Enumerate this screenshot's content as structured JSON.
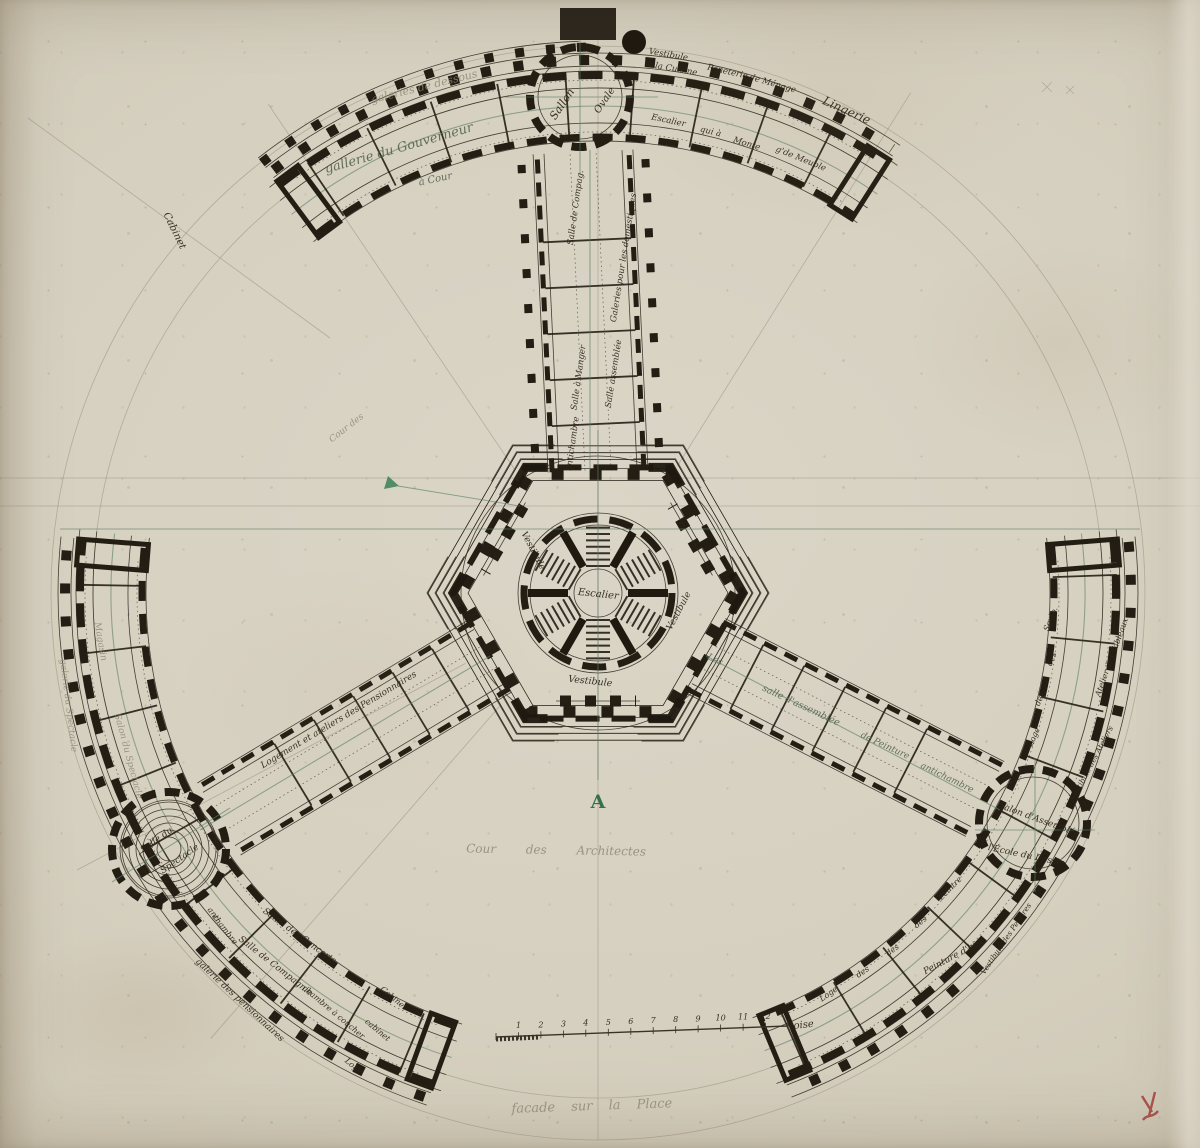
{
  "colors": {
    "paper": "#d6d0c0",
    "ink": "#241e14",
    "green_ink": "#557a5e",
    "pencil": "#8f8673",
    "red_chalk": "#9e3430"
  },
  "annotations": {
    "orientation_letter": "A",
    "court_label": "Cour des Architectes",
    "bottom_caption": "facade sur la Place",
    "scale_unit": "toise",
    "scale_numbers": [
      "1",
      "2",
      "3",
      "4",
      "5",
      "6",
      "7",
      "8",
      "9",
      "10",
      "11",
      "12"
    ]
  },
  "plan_labels": [
    {
      "text": "galeries de dessous",
      "x": 425,
      "y": 90,
      "rot": -14,
      "size": 11,
      "cls": "pencil"
    },
    {
      "text": "gallerie du Gouverneur",
      "x": 400,
      "y": 152,
      "rot": -16,
      "size": 13,
      "cls": "green"
    },
    {
      "text": "à Cour",
      "x": 436,
      "y": 182,
      "rot": -12,
      "size": 10,
      "cls": "green"
    },
    {
      "text": "Cabinet",
      "x": 172,
      "y": 232,
      "rot": 64,
      "size": 10,
      "cls": "ink"
    },
    {
      "text": "Sallon",
      "x": 565,
      "y": 106,
      "rot": -56,
      "size": 11,
      "cls": "ink"
    },
    {
      "text": "Ovale",
      "x": 607,
      "y": 102,
      "rot": -56,
      "size": 10,
      "cls": "ink"
    },
    {
      "text": "Vestibule",
      "x": 668,
      "y": 57,
      "rot": 10,
      "size": 8.5,
      "cls": "ink"
    },
    {
      "text": "à la Cuisine",
      "x": 672,
      "y": 71,
      "rot": 10,
      "size": 8.5,
      "cls": "ink"
    },
    {
      "text": "Paneterie",
      "x": 727,
      "y": 74,
      "rot": 13,
      "size": 8.5,
      "cls": "ink"
    },
    {
      "text": "de Ménage",
      "x": 772,
      "y": 86,
      "rot": 16,
      "size": 8.5,
      "cls": "ink"
    },
    {
      "text": "Lingerie",
      "x": 845,
      "y": 114,
      "rot": 24,
      "size": 12,
      "cls": "ink"
    },
    {
      "text": "Escalier",
      "x": 668,
      "y": 123,
      "rot": 12,
      "size": 8.5,
      "cls": "ink"
    },
    {
      "text": "qui à",
      "x": 710,
      "y": 134,
      "rot": 14,
      "size": 8.5,
      "cls": "ink"
    },
    {
      "text": "Monte",
      "x": 746,
      "y": 146,
      "rot": 17,
      "size": 8.5,
      "cls": "ink"
    },
    {
      "text": "g'de Meuble",
      "x": 800,
      "y": 161,
      "rot": 22,
      "size": 8.5,
      "cls": "ink"
    },
    {
      "text": "Salle de Compag.",
      "x": 578,
      "y": 208,
      "rot": -82,
      "size": 8.5,
      "cls": "ink"
    },
    {
      "text": "Salle à Manger",
      "x": 581,
      "y": 378,
      "rot": -82,
      "size": 8.5,
      "cls": "ink"
    },
    {
      "text": "antichambre",
      "x": 575,
      "y": 444,
      "rot": -82,
      "size": 8.5,
      "cls": "ink"
    },
    {
      "text": "Galeries pour les domestiques",
      "x": 626,
      "y": 258,
      "rot": -81,
      "size": 8.5,
      "cls": "ink"
    },
    {
      "text": "Salle assemblée",
      "x": 616,
      "y": 374,
      "rot": -81,
      "size": 8.5,
      "cls": "ink"
    },
    {
      "text": "Escalier",
      "x": 598,
      "y": 597,
      "rot": 6,
      "size": 10,
      "cls": "ink"
    },
    {
      "text": "Vestibule",
      "x": 590,
      "y": 684,
      "rot": 6,
      "size": 9.5,
      "cls": "ink"
    },
    {
      "text": "Vestibule",
      "x": 681,
      "y": 612,
      "rot": -62,
      "size": 9,
      "cls": "ink"
    },
    {
      "text": "Vestibule",
      "x": 531,
      "y": 552,
      "rot": 62,
      "size": 9,
      "cls": "ink"
    },
    {
      "text": "Les",
      "x": 714,
      "y": 662,
      "rot": 25,
      "size": 9,
      "cls": "green"
    },
    {
      "text": "salle d'assemblée",
      "x": 800,
      "y": 708,
      "rot": 25,
      "size": 9.5,
      "cls": "green"
    },
    {
      "text": "de Peinture",
      "x": 884,
      "y": 748,
      "rot": 25,
      "size": 9,
      "cls": "green"
    },
    {
      "text": "antichambre",
      "x": 946,
      "y": 780,
      "rot": 26,
      "size": 9,
      "cls": "green"
    },
    {
      "text": "Logement et ateliers des Pensionnaires",
      "x": 340,
      "y": 722,
      "rot": -31,
      "size": 9,
      "cls": "ink"
    },
    {
      "text": "Magasin",
      "x": 98,
      "y": 642,
      "rot": 80,
      "size": 9,
      "cls": "pencil"
    },
    {
      "text": "galerie du Spectacle",
      "x": 66,
      "y": 706,
      "rot": 83,
      "size": 9,
      "cls": "pencil"
    },
    {
      "text": "Salon du Spectacle",
      "x": 126,
      "y": 757,
      "rot": 75,
      "size": 9,
      "cls": "pencil"
    },
    {
      "text": "Salle du",
      "x": 158,
      "y": 842,
      "rot": -35,
      "size": 9,
      "cls": "ink"
    },
    {
      "text": "Spectacle",
      "x": 181,
      "y": 861,
      "rot": -35,
      "size": 9,
      "cls": "ink"
    },
    {
      "text": "anti",
      "x": 212,
      "y": 916,
      "rot": 52,
      "size": 8,
      "cls": "ink"
    },
    {
      "text": "chambre",
      "x": 223,
      "y": 931,
      "rot": 52,
      "size": 8,
      "cls": "ink"
    },
    {
      "text": "Salon des Concerts",
      "x": 298,
      "y": 938,
      "rot": 36,
      "size": 9,
      "cls": "ink"
    },
    {
      "text": "Salle de Compagnie",
      "x": 274,
      "y": 968,
      "rot": 38,
      "size": 9,
      "cls": "ink"
    },
    {
      "text": "galerie des pensionnaires",
      "x": 238,
      "y": 1002,
      "rot": 43,
      "size": 9,
      "cls": "ink"
    },
    {
      "text": "chambre à coucher",
      "x": 332,
      "y": 1014,
      "rot": 40,
      "size": 8,
      "cls": "ink"
    },
    {
      "text": "Cabinet",
      "x": 392,
      "y": 1000,
      "rot": 40,
      "size": 8,
      "cls": "ink"
    },
    {
      "text": "cabinet",
      "x": 376,
      "y": 1032,
      "rot": 40,
      "size": 8,
      "cls": "ink"
    },
    {
      "text": "Loge",
      "x": 352,
      "y": 1068,
      "rot": 40,
      "size": 8,
      "cls": "ink"
    },
    {
      "text": "Salon d'Assemblée",
      "x": 1038,
      "y": 822,
      "rot": 20,
      "size": 9,
      "cls": "ink"
    },
    {
      "text": "l'École du Dessin",
      "x": 1026,
      "y": 858,
      "rot": 12,
      "size": 9,
      "cls": "ink"
    },
    {
      "text": "Sculp.",
      "x": 1053,
      "y": 620,
      "rot": -68,
      "size": 8,
      "cls": "ink"
    },
    {
      "text": "des",
      "x": 1054,
      "y": 660,
      "rot": -68,
      "size": 8,
      "cls": "ink"
    },
    {
      "text": "des",
      "x": 1042,
      "y": 700,
      "rot": -68,
      "size": 8,
      "cls": "ink"
    },
    {
      "text": "Loge",
      "x": 1036,
      "y": 738,
      "rot": -66,
      "size": 8,
      "cls": "ink"
    },
    {
      "text": "Atelier des Tableaux",
      "x": 1114,
      "y": 658,
      "rot": -70,
      "size": 8,
      "cls": "ink"
    },
    {
      "text": "Vestibule des Ateliers",
      "x": 1094,
      "y": 764,
      "rot": -62,
      "size": 7.5,
      "cls": "ink"
    },
    {
      "text": "Vestibule des Peintres",
      "x": 1008,
      "y": 940,
      "rot": -56,
      "size": 7.5,
      "cls": "ink"
    },
    {
      "text": "Peinture d'hist.",
      "x": 956,
      "y": 958,
      "rot": -28,
      "size": 9,
      "cls": "ink"
    },
    {
      "text": "Loge",
      "x": 830,
      "y": 996,
      "rot": -35,
      "size": 8,
      "cls": "ink"
    },
    {
      "text": "des",
      "x": 864,
      "y": 974,
      "rot": -35,
      "size": 8,
      "cls": "ink"
    },
    {
      "text": "des",
      "x": 894,
      "y": 952,
      "rot": -37,
      "size": 8,
      "cls": "ink"
    },
    {
      "text": "des",
      "x": 922,
      "y": 924,
      "rot": -40,
      "size": 8,
      "cls": "ink"
    },
    {
      "text": "Peintre",
      "x": 952,
      "y": 890,
      "rot": -45,
      "size": 8,
      "cls": "ink"
    },
    {
      "text": "A",
      "x": 598,
      "y": 808,
      "rot": 0,
      "size": 19,
      "cls": "green-cap"
    },
    {
      "text": "Cour des Architectes",
      "x": 556,
      "y": 854,
      "rot": 1,
      "size": 12,
      "cls": "pencil",
      "ws": 26
    },
    {
      "text": "facade sur la Place",
      "x": 592,
      "y": 1110,
      "rot": -2,
      "size": 13,
      "cls": "pencil",
      "ws": 12
    },
    {
      "text": "toise",
      "x": 802,
      "y": 1028,
      "rot": -6,
      "size": 10,
      "cls": "ink"
    },
    {
      "text": "Cour des",
      "x": 348,
      "y": 430,
      "rot": -38,
      "size": 9,
      "cls": "pencil"
    }
  ]
}
